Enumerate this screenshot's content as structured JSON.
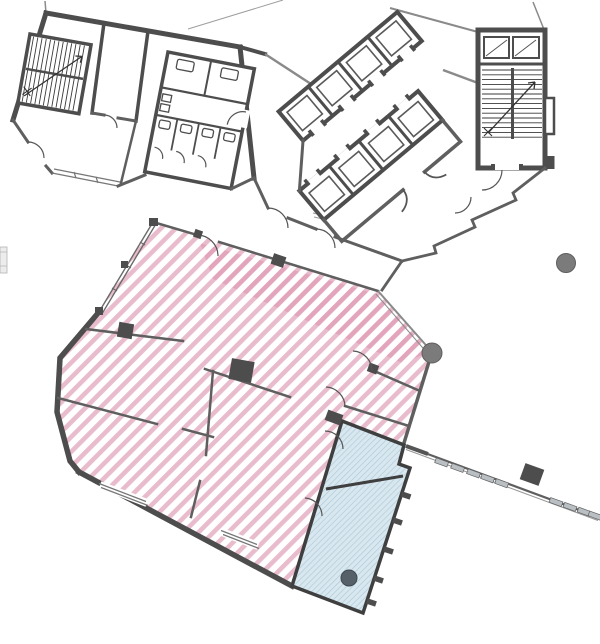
{
  "canvas": {
    "width": 600,
    "height": 644,
    "background": "#ffffff"
  },
  "plan": {
    "type": "architectural-floor-plan",
    "wall_color": "#4d4d4d",
    "zones": [
      {
        "id": "pink-hatched-area",
        "description": "large open-plan area highlighted with pink diagonal hatching",
        "hatch_color": "#e9bccd",
        "accent_color": "#dd92ae",
        "outline_color": "#555555"
      },
      {
        "id": "blue-hatched-area",
        "description": "two-room annex highlighted with blue fine hatching",
        "fill_color": "#d9e7ef",
        "hatch_color": "#accadb",
        "outline_color": "#3f3f3f"
      }
    ],
    "markers": [
      {
        "id": "column-marker-east",
        "cx": 566,
        "cy": 263,
        "r": 9.5,
        "fill": "#7b7b7b",
        "stroke": "#5e5e5e"
      },
      {
        "id": "column-marker-pink-corner",
        "cx": 432,
        "cy": 353,
        "r": 10,
        "fill": "#7b7b7b",
        "stroke": "#5e5e5e"
      },
      {
        "id": "column-marker-blue-room",
        "cx": 349,
        "cy": 578,
        "r": 8,
        "fill": "#566069",
        "stroke": "#3f4850"
      }
    ],
    "features": {
      "stairwells": 2,
      "elevator_shafts": 8,
      "wc_stalls": 6,
      "door_swings": 12,
      "window_walls": 3
    }
  }
}
